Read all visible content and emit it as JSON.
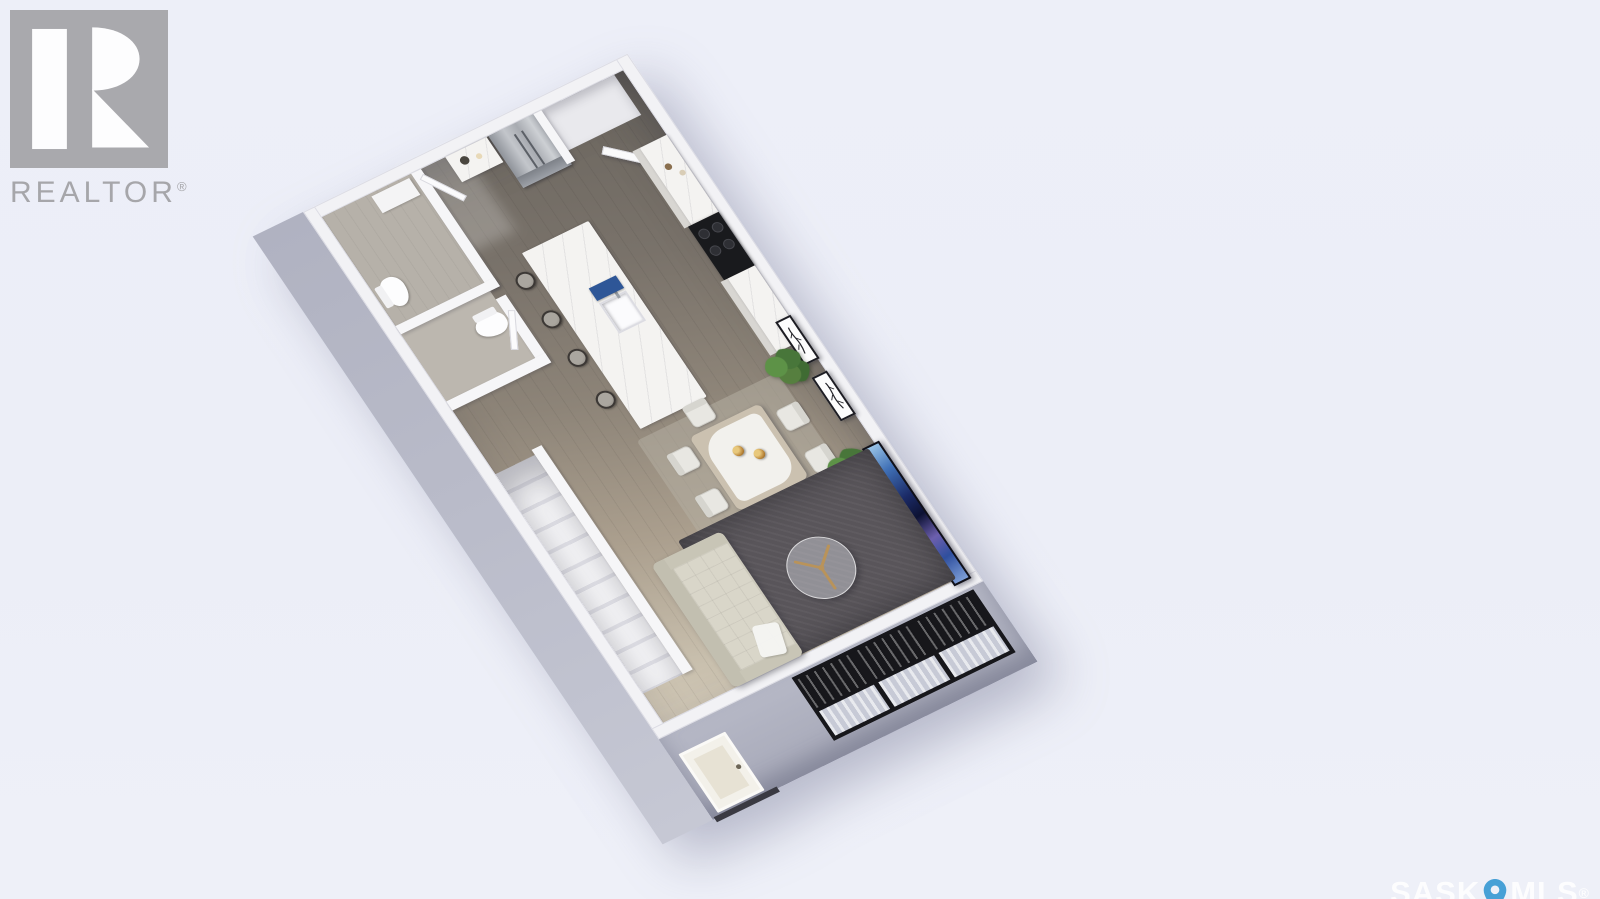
{
  "branding": {
    "realtor_logo_text": "REALTOR",
    "registered_symbol": "®"
  },
  "watermark": {
    "prefix": "SASK",
    "suffix": "MLS",
    "registered_symbol": "®",
    "pin_color": "#47a0d6",
    "text_color": "rgba(255,255,255,0.85)"
  },
  "palette": {
    "background": "#edeff8",
    "exterior_wall": "#b4b6c4",
    "interior_wall": "#f4f4f6",
    "floor_dark": "#6b665f",
    "floor_light": "#d2c9b8",
    "area_rug": "#59555a",
    "sofa": "#d7d4c7",
    "island_marble": "#f4f3f1",
    "stove": "#191a1d",
    "accent_blue_tray": "#2e5697",
    "tv_art_blue": "#1b2a66",
    "plant_green": "#4c7a3c",
    "gold": "#c29a52",
    "window_frame": "#17171b",
    "logo_gray": "#a6a6aa"
  },
  "scene": {
    "type": "3d-isometric-floor-plan",
    "rooms": [
      "bathroom",
      "water-closet",
      "entry-hall",
      "kitchen",
      "dining-area",
      "living-room",
      "staircase",
      "corner-closet"
    ],
    "furniture_and_fixtures": [
      "refrigerator",
      "coffee-counter",
      "corner-closet-door",
      "stove-cooktop",
      "kitchen-counters",
      "kitchen-island",
      "island-sink",
      "blue-tray",
      "bar-stools",
      "dining-table",
      "dining-chairs",
      "gold-vases",
      "framed-botanical-prints",
      "potted-plants",
      "tv-artwork",
      "area-rug",
      "round-glass-coffee-table",
      "tufted-sofa",
      "throw-blanket",
      "toilets",
      "vanity",
      "stairs",
      "entry-door",
      "black-framed-windows"
    ]
  }
}
